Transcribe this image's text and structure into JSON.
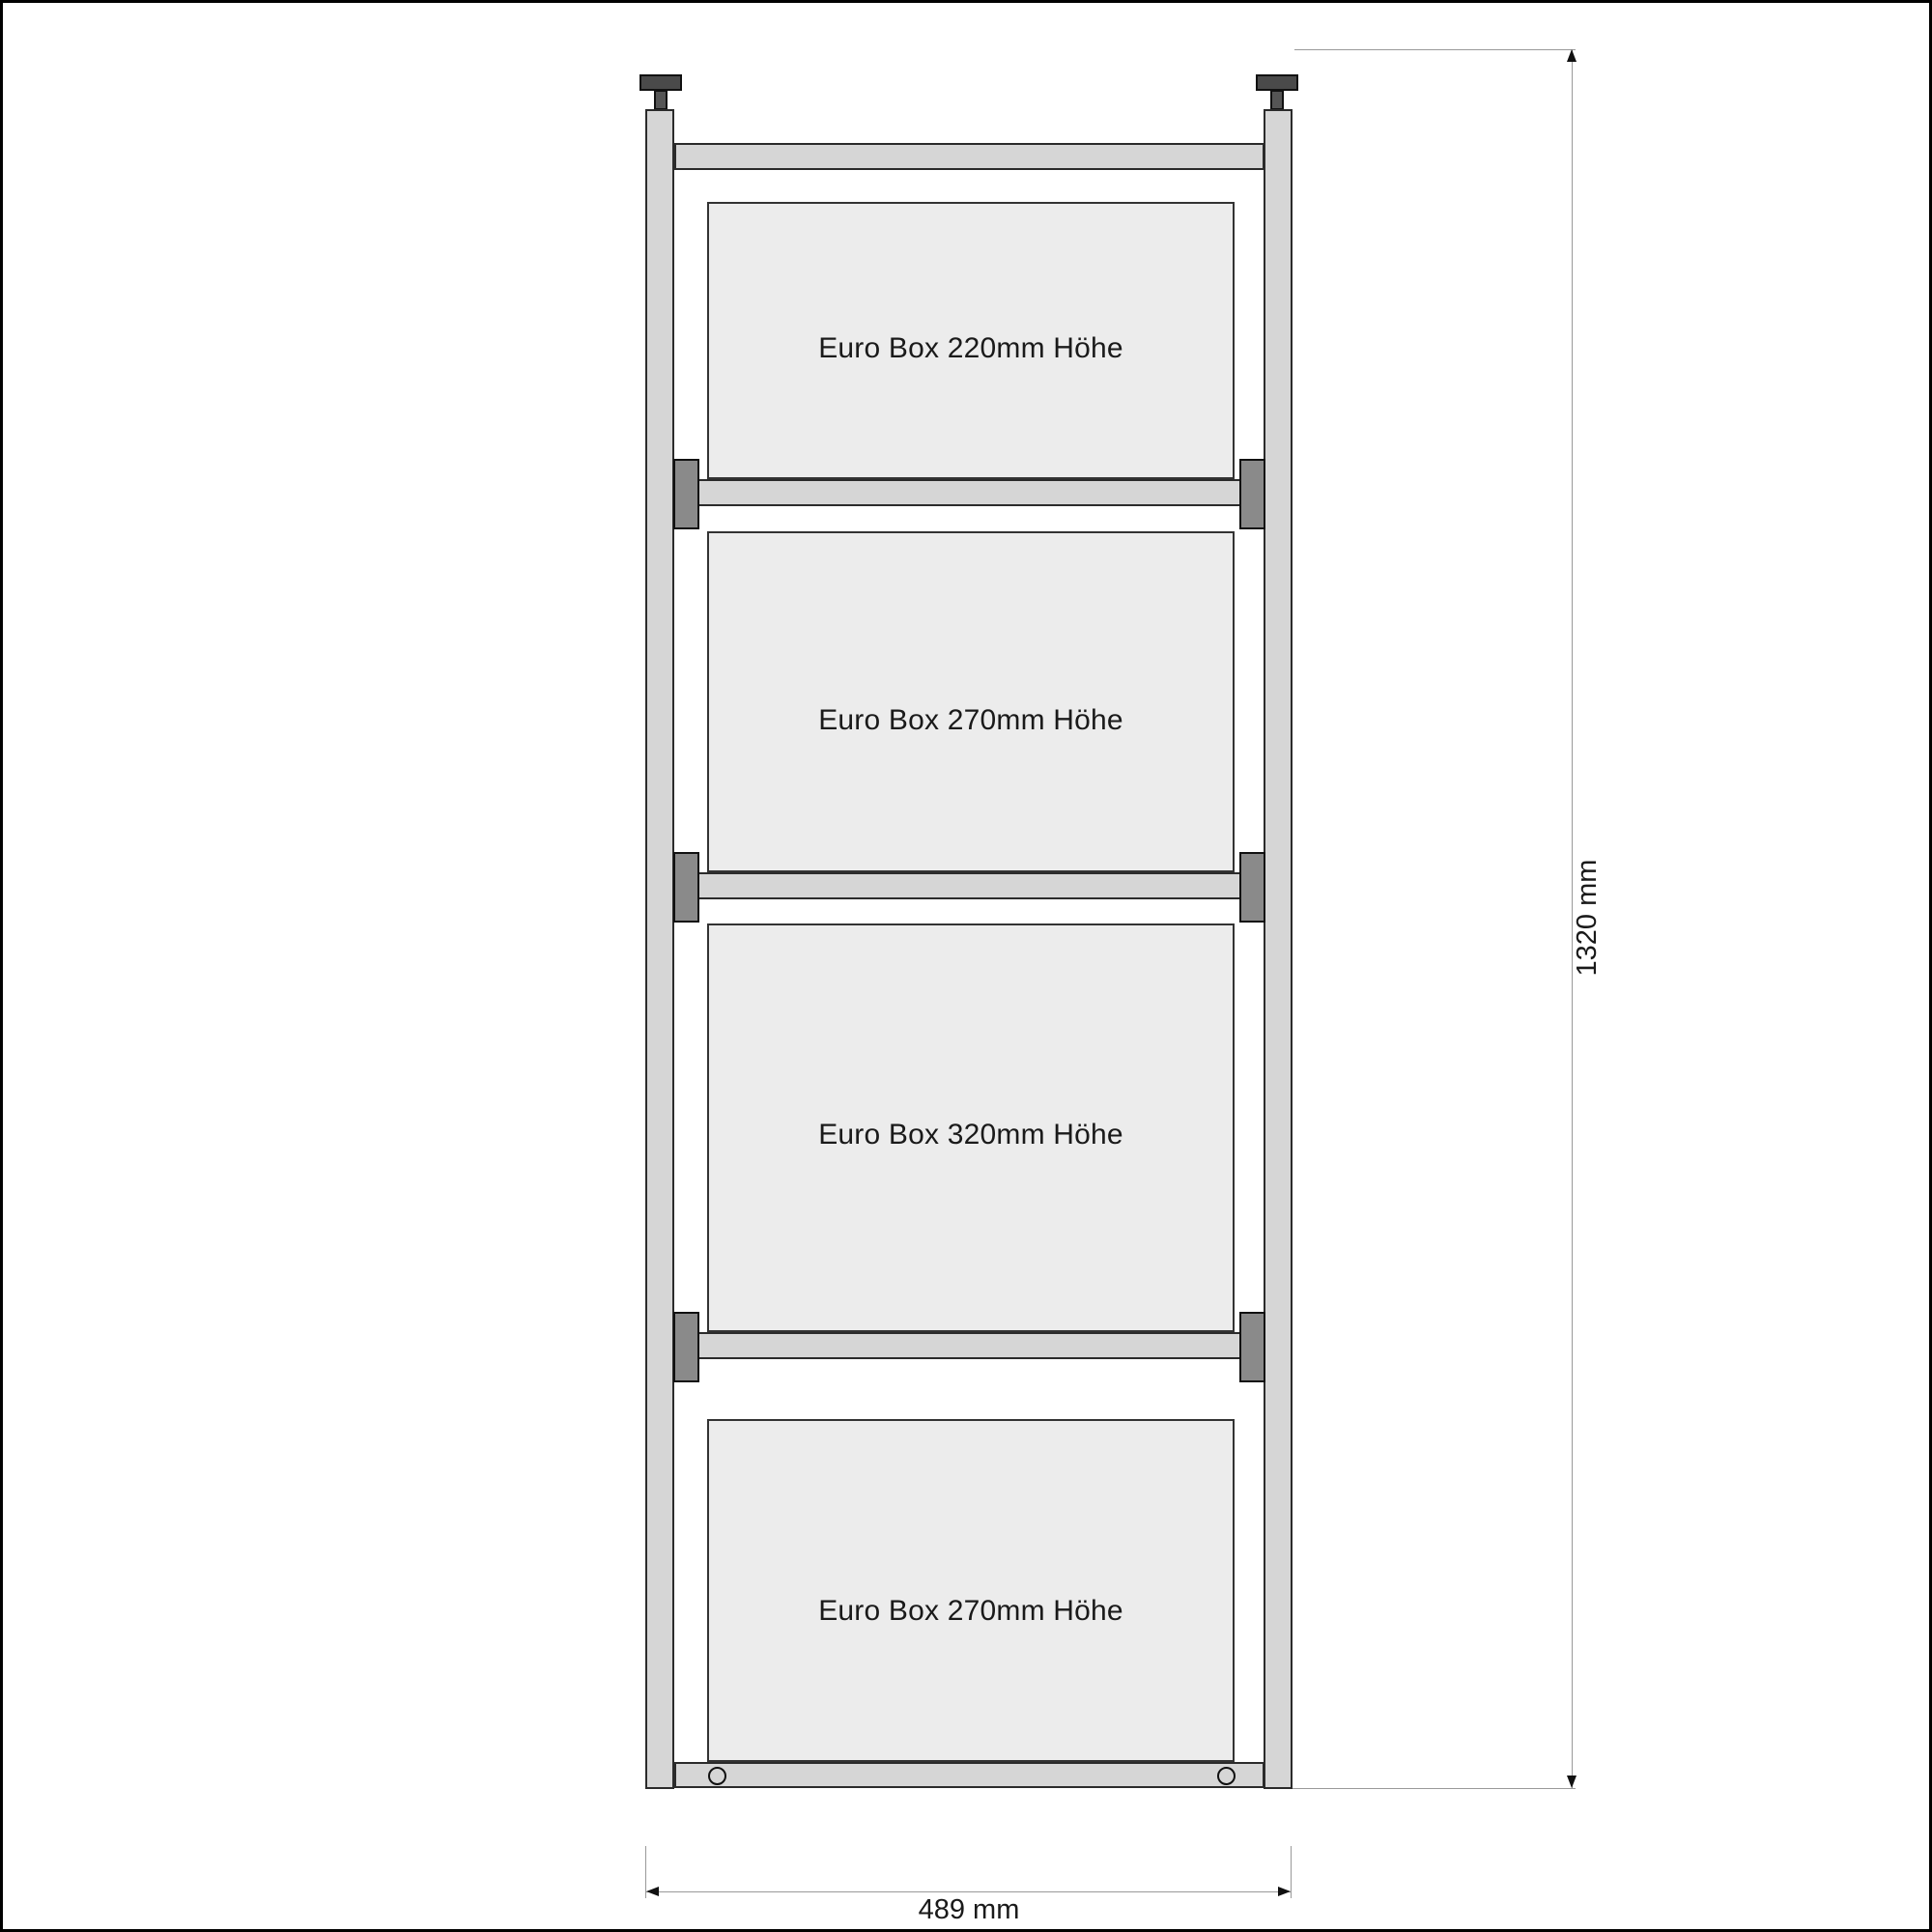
{
  "drawing": {
    "boxes": [
      {
        "label": "Euro Box 220mm Höhe"
      },
      {
        "label": "Euro Box 270mm Höhe"
      },
      {
        "label": "Euro Box 320mm Höhe"
      },
      {
        "label": "Euro Box 270mm Höhe"
      }
    ],
    "dimensions": {
      "height_label": "1320 mm",
      "width_label": "489 mm"
    },
    "icons": {
      "clamp_knob": "t-screw-shape",
      "mounting_hole": "circle-outline"
    }
  },
  "colors": {
    "background": "#ffffff",
    "frame_fill": "#d6d6d6",
    "frame_outline": "#2b2b2b",
    "box_fill": "#ececec",
    "box_outline": "#333333",
    "connector_fill": "#8a8a8a",
    "knob_fill": "#4a4a4a",
    "dim_line": "#9a9a9a",
    "ink": "#1a1a1a"
  }
}
